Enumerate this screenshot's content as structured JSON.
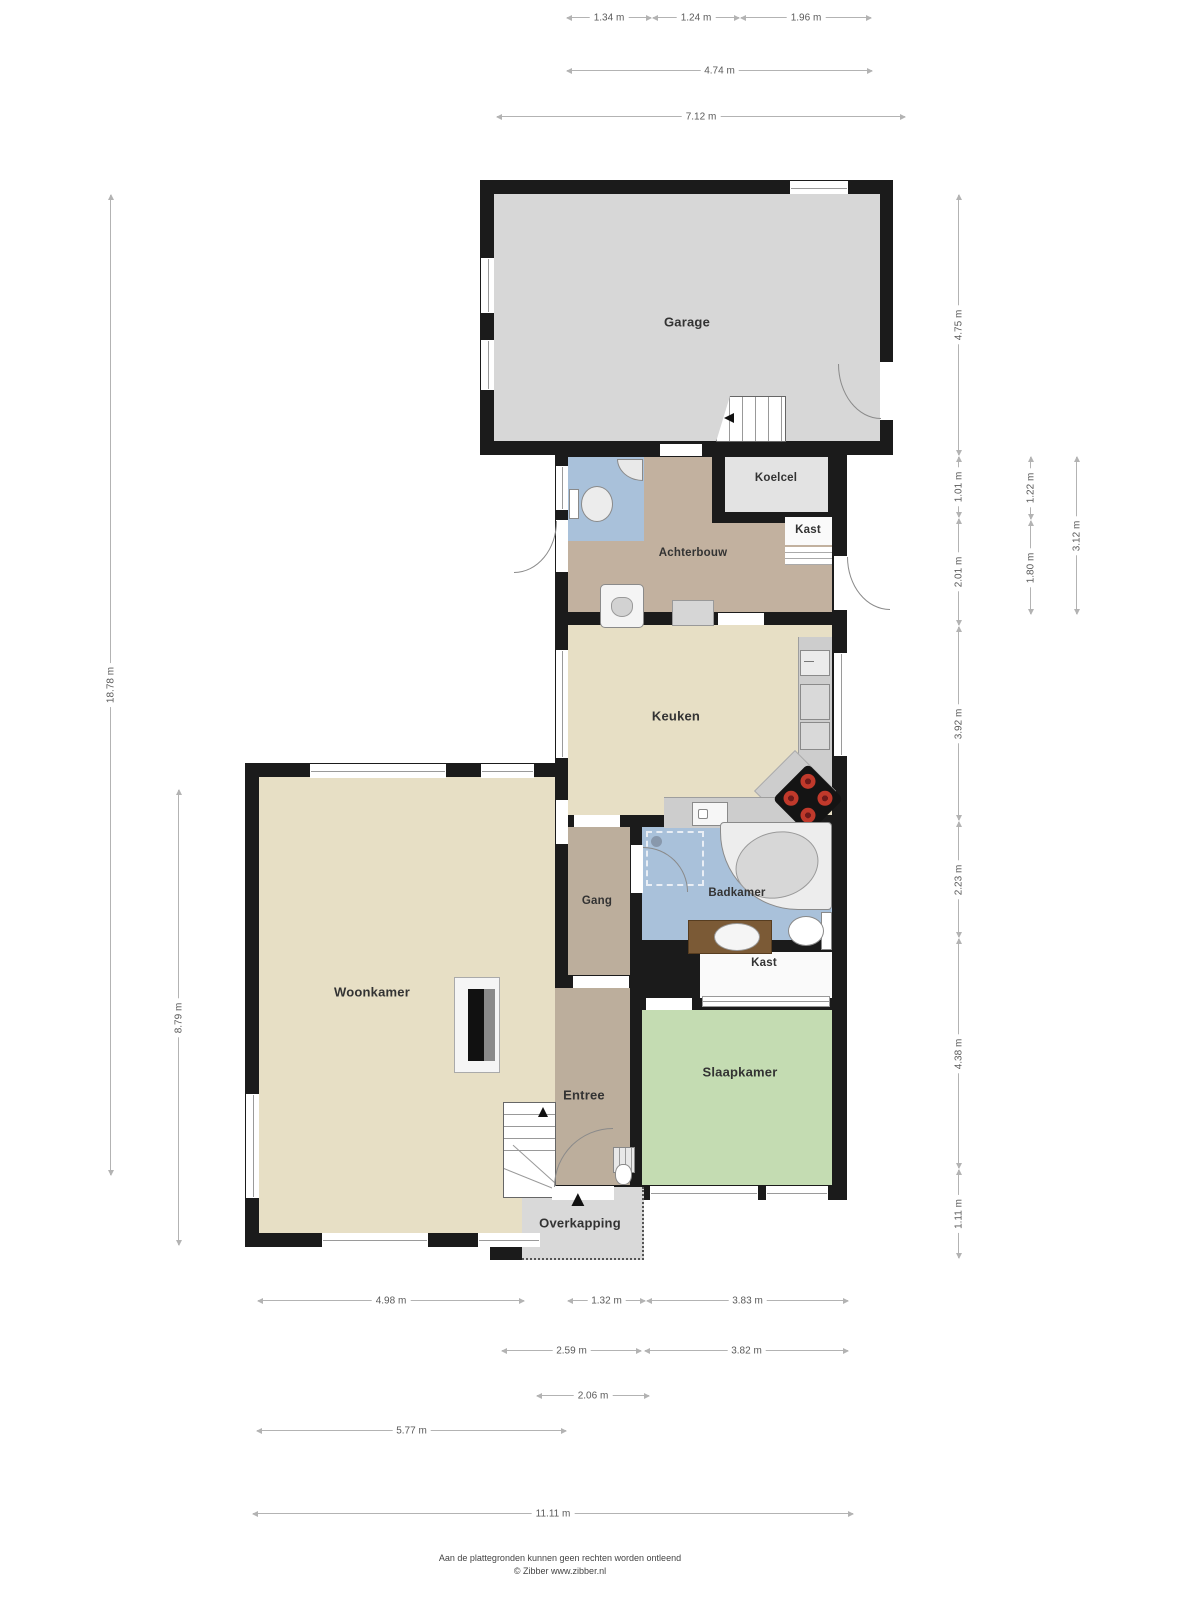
{
  "page": {
    "width": 1200,
    "height": 1600,
    "background": "#ffffff",
    "type": "floorplan-begane-grond"
  },
  "rooms": {
    "garage": "Garage",
    "koelcel": "Koelcel",
    "kast_achterbouw": "Kast",
    "achterbouw": "Achterbouw",
    "keuken": "Keuken",
    "gang": "Gang",
    "badkamer": "Badkamer",
    "woonkamer": "Woonkamer",
    "kast_slaapkamer": "Kast",
    "slaapkamer": "Slaapkamer",
    "entree": "Entree",
    "overkapping": "Overkapping"
  },
  "dimensions": {
    "top": [
      "1.34 m",
      "1.24 m",
      "1.96 m",
      "4.74 m",
      "7.12 m"
    ],
    "left": [
      "18.78 m",
      "8.79 m"
    ],
    "right": [
      "4.75 m",
      "1.01 m",
      "2.01 m",
      "3.92 m",
      "2.23 m",
      "4.38 m",
      "1.11 m",
      "1.22 m",
      "1.80 m",
      "3.12 m"
    ],
    "bottom": [
      "4.98 m",
      "1.32 m",
      "3.83 m",
      "2.59 m",
      "3.82 m",
      "2.06 m",
      "5.77 m",
      "11.11 m"
    ]
  },
  "icons": {
    "entrance_arrow": "▲"
  },
  "colors": {
    "wall": "#1b1b1b",
    "garage_floor": "#d7d7d7",
    "coldroom_floor": "#e3e3e3",
    "utility_floor": "#c2b19f",
    "kitchen_living_floor": "#e7dfc5",
    "bathroom_floor": "#a9c1da",
    "bedroom_floor": "#c4dcb2",
    "closet_floor": "#fafafa",
    "counter": "#cdcdcd",
    "stove_burner": "#c0392b",
    "canopy_floor": "#d9d9d9",
    "dimension_line": "#b3b3b3"
  },
  "footer": {
    "disclaimer": "Aan de plattegronden kunnen geen rechten worden ontleend",
    "credit": "© Zibber www.zibber.nl"
  }
}
